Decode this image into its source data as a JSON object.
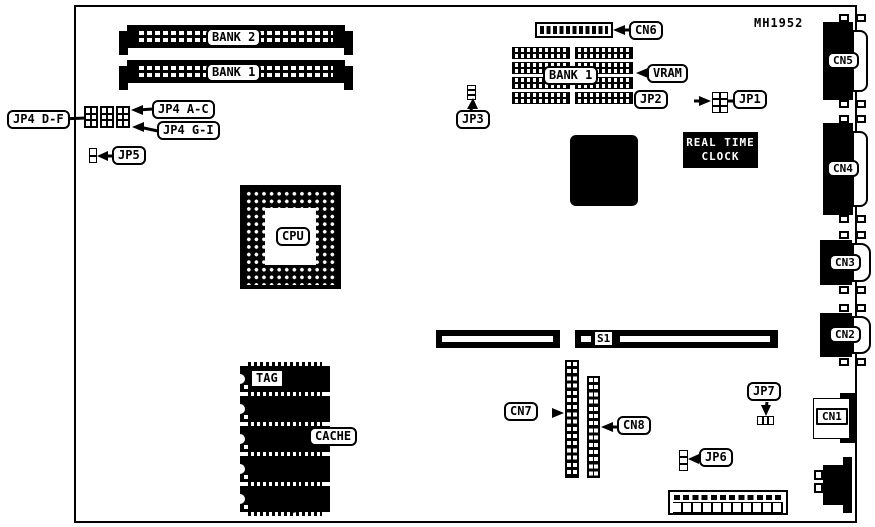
{
  "board": {
    "part_number": "MH1952",
    "simm": {
      "bank2": "BANK 2",
      "bank1": "BANK 1"
    },
    "cpu": "CPU",
    "vram": {
      "bank": "BANK 1",
      "label": "VRAM"
    },
    "rtc": {
      "line1": "REAL TIME",
      "line2": "CLOCK"
    },
    "slot": "S1",
    "cache": {
      "tag": "TAG",
      "label": "CACHE"
    },
    "jumpers": {
      "jp4_df": "JP4 D-F",
      "jp4_ac": "JP4 A-C",
      "jp4_gi": "JP4 G-I",
      "jp5": "JP5",
      "jp3": "JP3",
      "jp2": "JP2",
      "jp1": "JP1",
      "jp7": "JP7",
      "jp6": "JP6"
    },
    "connectors": {
      "cn1": "CN1",
      "cn2": "CN2",
      "cn3": "CN3",
      "cn4": "CN4",
      "cn5": "CN5",
      "cn6": "CN6",
      "cn7": "CN7",
      "cn8": "CN8"
    },
    "colors": {
      "line": "#000000",
      "bg": "#ffffff"
    }
  }
}
